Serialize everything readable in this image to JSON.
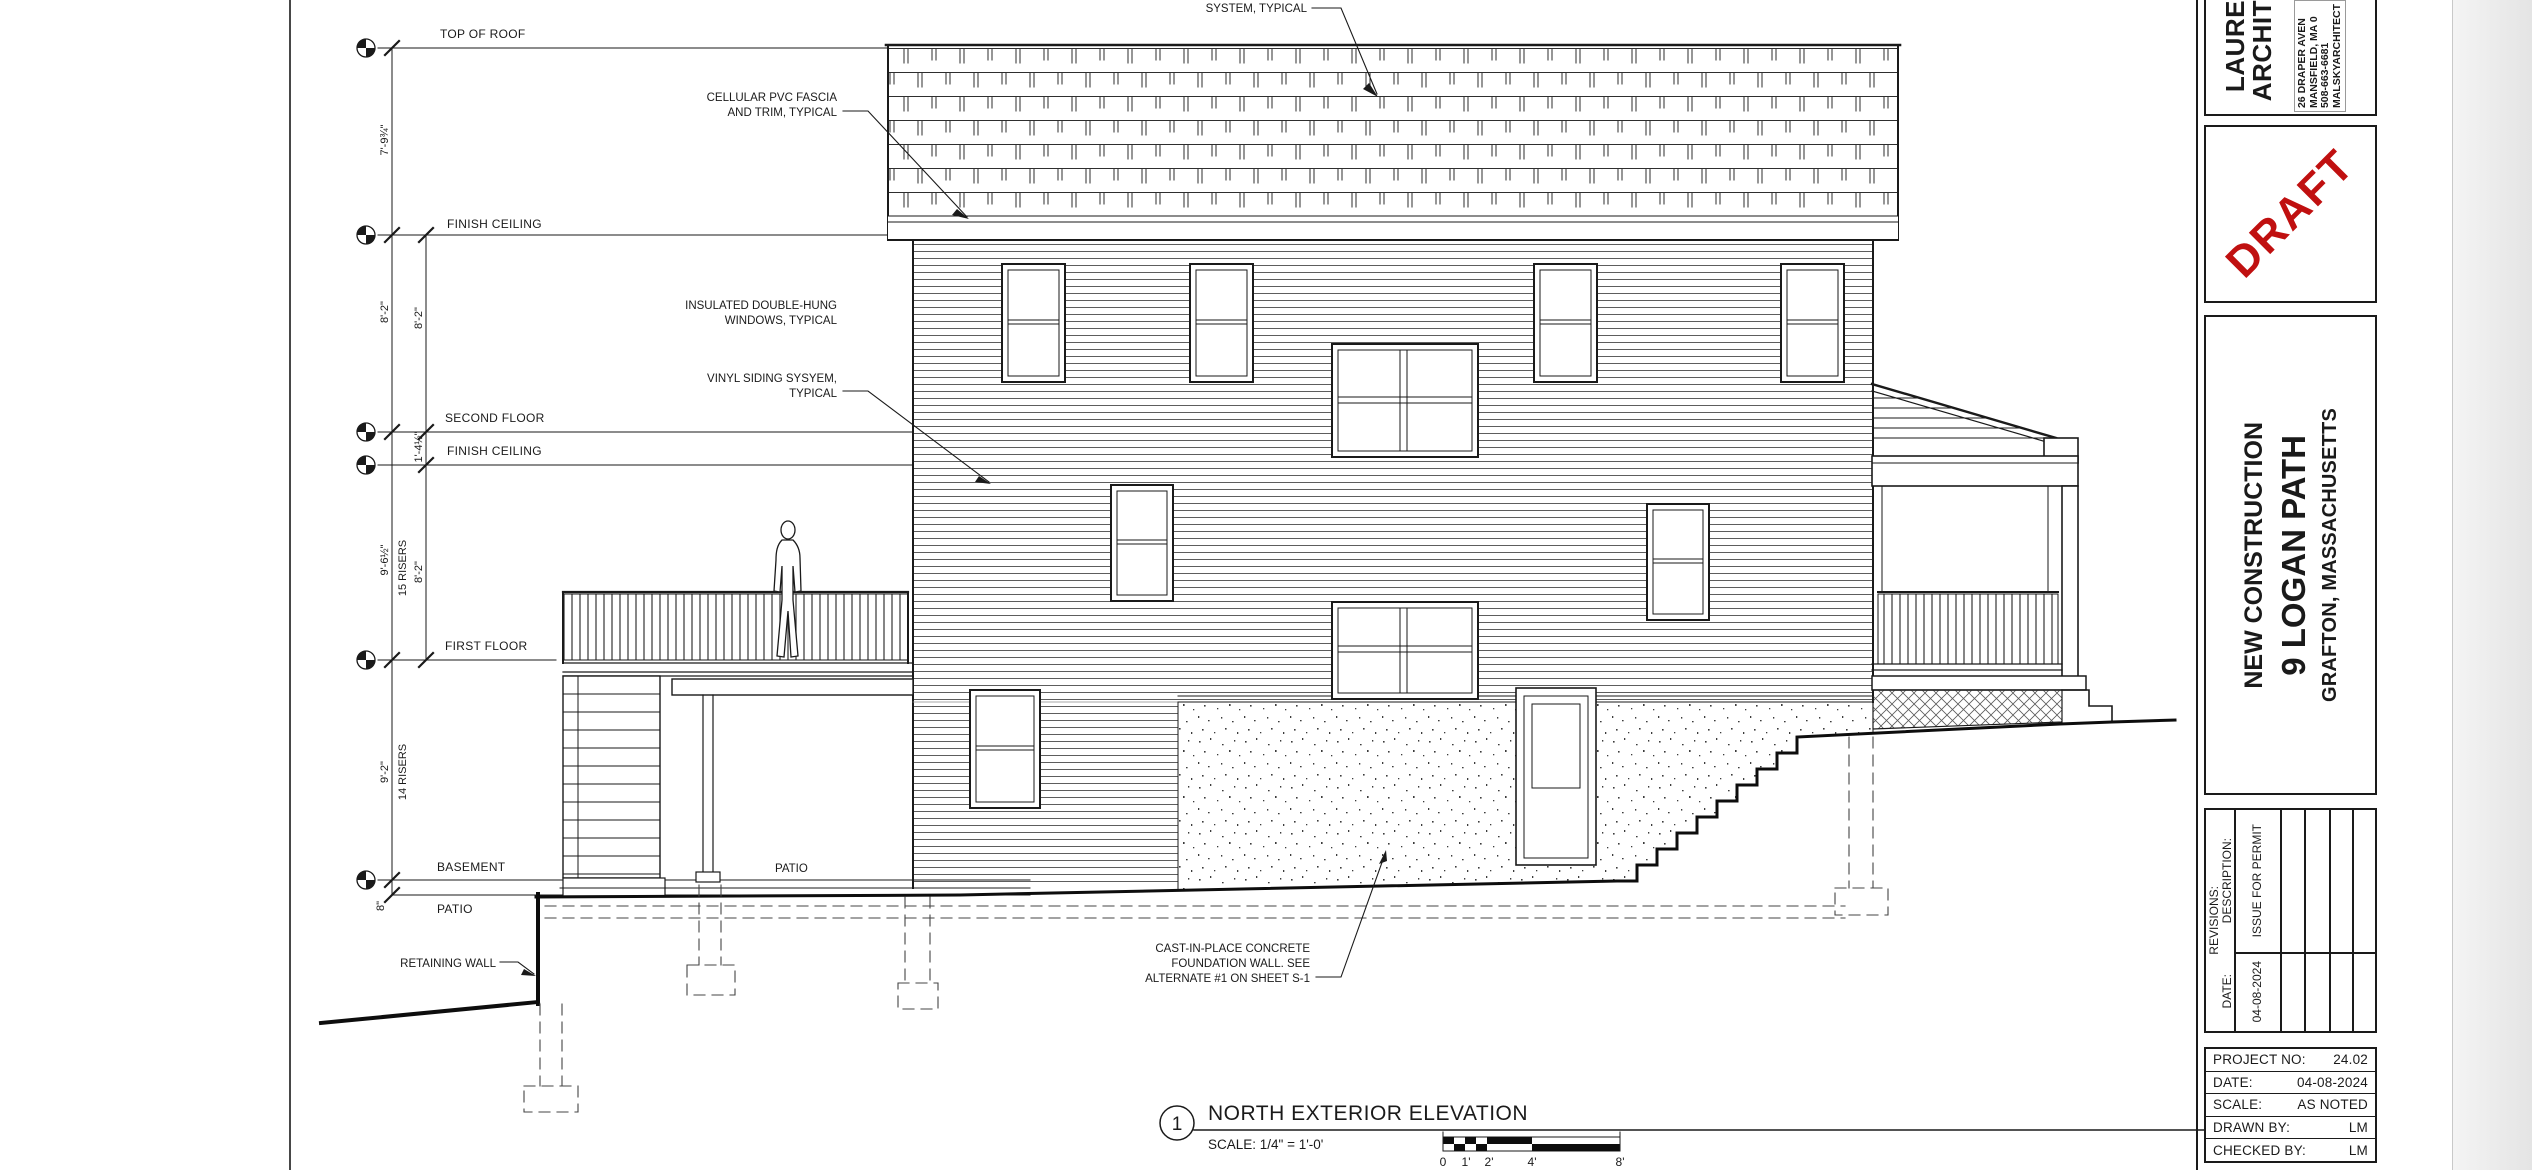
{
  "page": {
    "background": "#ffffff",
    "outside_background": "#ededed",
    "line_color": "#1a1a1a",
    "draft_color": "#c01010"
  },
  "drawing": {
    "levels": {
      "top_of_roof": "TOP OF ROOF",
      "finish_ceiling_upper": "FINISH CEILING",
      "second_floor": "SECOND FLOOR",
      "finish_ceiling_lower": "FINISH CEILING",
      "first_floor": "FIRST FLOOR",
      "basement": "BASEMENT",
      "patio": "PATIO"
    },
    "dims": {
      "outer1": "7'-9¾\"",
      "outer2": "8'-2\"",
      "outer3": "9'-6½\"",
      "outer3_risers": "15 RISERS",
      "outer4": "9'-2\"",
      "outer4_risers": "14 RISERS",
      "outer5": "8\"",
      "inner1": "8'-2\"",
      "inner2": "1'-4½\"",
      "inner3": "8'-2\""
    },
    "annotations": {
      "roof_note": "SYSTEM, TYPICAL",
      "fascia1": "CELLULAR PVC FASCIA",
      "fascia2": "AND TRIM, TYPICAL",
      "windows1": "INSULATED DOUBLE-HUNG",
      "windows2": "WINDOWS, TYPICAL",
      "siding1": "VINYL SIDING SYSYEM,",
      "siding2": "TYPICAL",
      "foundation1": "CAST-IN-PLACE CONCRETE",
      "foundation2": "FOUNDATION WALL. SEE",
      "foundation3": "ALTERNATE #1 ON SHEET S-1"
    },
    "site": {
      "patio_text": "PATIO",
      "retaining_wall": "RETAINING WALL"
    }
  },
  "view_title": {
    "number": "1",
    "title": "NORTH EXTERIOR ELEVATION",
    "scale_note": "SCALE: 1/4\" = 1'-0'",
    "bar": {
      "b0": "0",
      "b1": "1'",
      "b2": "2'",
      "b3": "4'",
      "b4": "8'"
    }
  },
  "title_block": {
    "architect": {
      "name1": "LAURE",
      "name2": "ARCHIT",
      "addr1": "26 DRAPER AVEN",
      "addr2": "MANSFIELD, MA 0",
      "addr3": "508-663-6681",
      "addr4": "MALSKYARCHITECT"
    },
    "draft_stamp": "DRAFT",
    "project": {
      "line1": "NEW CONSTRUCTION",
      "line2": "9 LOGAN PATH",
      "line3": "GRAFTON, MASSACHUSETTS"
    },
    "revisions": {
      "title": "REVISIONS:",
      "description_label": "DESCRIPTION:",
      "date_label": "DATE:",
      "entry_description": "ISSUE FOR PERMIT",
      "entry_date": "04-08-2024"
    },
    "info": {
      "rows": [
        {
          "label": "PROJECT NO:",
          "value": "24.02"
        },
        {
          "label": "DATE:",
          "value": "04-08-2024"
        },
        {
          "label": "SCALE:",
          "value": "AS NOTED"
        },
        {
          "label": "DRAWN BY:",
          "value": "LM"
        },
        {
          "label": "CHECKED BY:",
          "value": "LM"
        }
      ]
    }
  }
}
